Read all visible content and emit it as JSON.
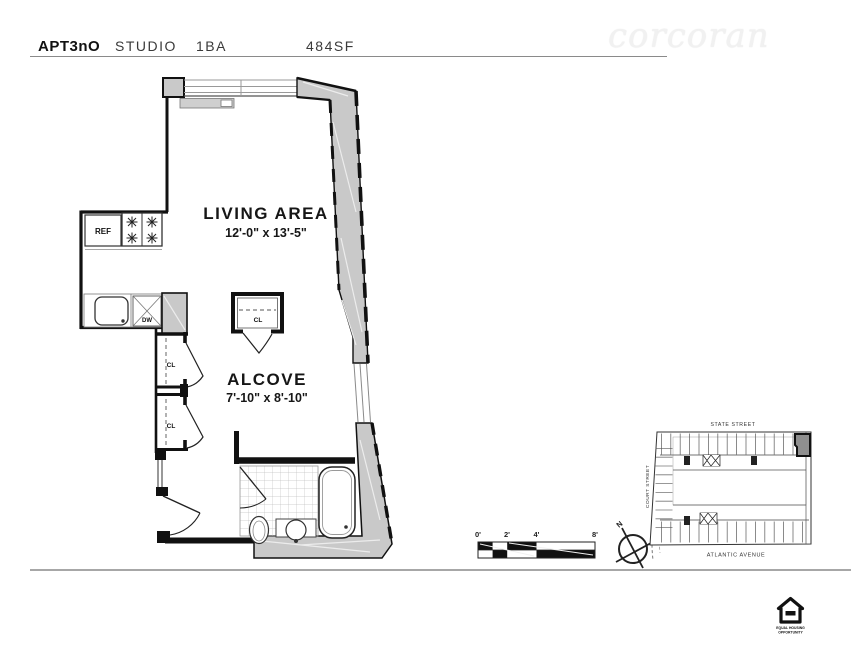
{
  "header": {
    "apt": "APT3nO",
    "type": "STUDIO",
    "bath": "1BA",
    "area": "484SF"
  },
  "watermark": "corcoran",
  "rooms": {
    "living": {
      "name": "LIVING AREA",
      "dims": "12'-0\" x 13'-5\""
    },
    "alcove": {
      "name": "ALCOVE",
      "dims": "7'-10\" x 8'-10\""
    }
  },
  "fixtures": {
    "ref": "REF",
    "dw": "DW",
    "cl": "CL"
  },
  "scale": {
    "ticks": [
      "0'",
      "2'",
      "4'",
      "8'"
    ]
  },
  "compass": {
    "north": "N"
  },
  "map": {
    "top": "STATE STREET",
    "left": "COURT STREET",
    "bottom": "ATLANTIC AVENUE"
  },
  "logo": {
    "line1": "EQUAL HOUSING",
    "line2": "OPPORTUNITY"
  },
  "colors": {
    "wall_gray": "#c9c9c9",
    "ink": "#1a1a1a",
    "rule_gray": "#9a9a9a"
  }
}
